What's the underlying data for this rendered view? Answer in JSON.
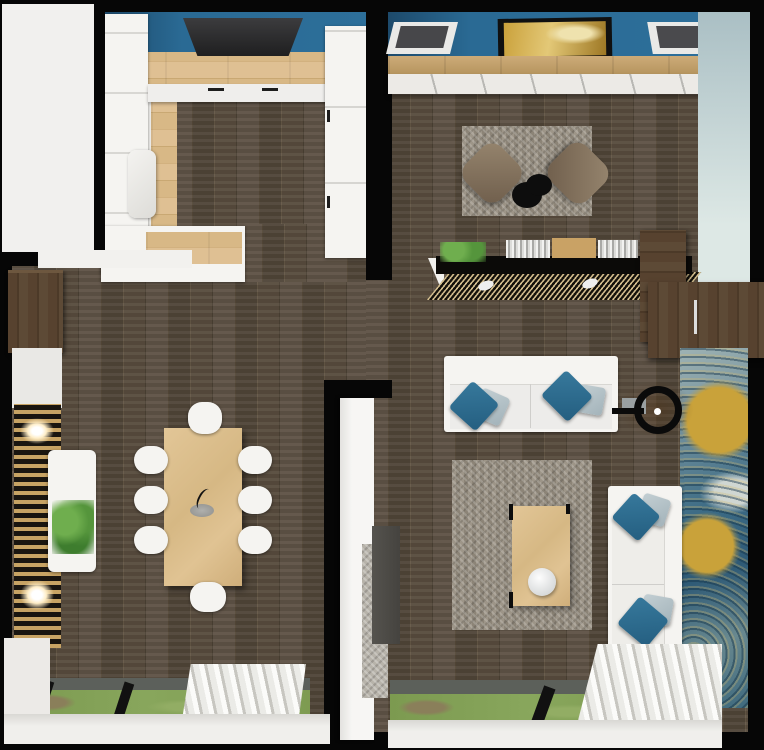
{
  "scene": {
    "title": "Apartment interior 3D floor plan, top-down render",
    "rooms": [
      {
        "id": "kitchen",
        "label": "Kitchen"
      },
      {
        "id": "dining-area",
        "label": "Dining area"
      },
      {
        "id": "living-room",
        "label": "Living room"
      },
      {
        "id": "hallway",
        "label": "Hallway"
      }
    ]
  },
  "labels": {
    "kitchen": "Kitchen",
    "dining_area": "Dining area",
    "living_room": "Living room",
    "hallway": "Hallway",
    "exterior": "Exterior",
    "kitchen_worktop": "Kitchen U-shaped worktop",
    "kitchen_blue_wall": "Blue kitchen wall",
    "range_hood": "Range hood",
    "sink": "Kitchen sink",
    "cabinets_left": "White cabinet run",
    "cabinets_tall": "Tall cabinet / fridge column",
    "counter_bottom": "Lower counter peninsula",
    "entry_wardrobe": "Entry wardrobe",
    "slat_wall": "Vertical wood slat accent wall",
    "wall_sconce": "Wall light",
    "floating_sideboard": "Floating sideboard",
    "plant": "Plant",
    "dining_table": "Dining table",
    "dining_chair": "Dining chair",
    "centerpiece": "Table centerpiece",
    "window": "Window with garden view",
    "window_mullion": "Window frame",
    "curtain": "Pleated curtain",
    "window_sill": "Window sill",
    "interior_door": "Open interior door",
    "partition_wall": "Partition wall",
    "tv_wall_blue": "Blue accent wall",
    "ceiling_light": "Recessed ceiling light panel",
    "painting": "Framed painting",
    "wall_shelf": "Wood wall shelf",
    "long_sideboard": "Long white sideboard",
    "teal_wall": "Pale teal side wall",
    "rug": "Gray shag area rug",
    "lounge_chair": "Lounge chair",
    "side_table": "Black side table",
    "media_console": "Slatted media console",
    "books": "Row of books",
    "open_door": "Open wood door",
    "mural": "Blue and gold wall mural",
    "sofa": "White sofa",
    "throw_pillow": "Throw pillow",
    "wall_clock": "Ring wall clock",
    "coffee_table": "Coffee table",
    "decor_bowl": "Decor bowl",
    "tv_unit": "TV unit",
    "floor_runner": "Gray floor runner"
  },
  "palette": {
    "wall_outline": "#060606",
    "blue_accent_wall": "#2a6a94",
    "teal_side_wall": "#c3d4d2",
    "dark_floor": "#574b3e",
    "light_wood": "#d9ba8b",
    "shag_rug_gray": "#968e81",
    "lounge_chair_brown": "#8a7966",
    "pillow_teal": "#2a6c90",
    "pillow_gray_blue": "#b3c2c8",
    "mural_blue": "#3c6b85",
    "mural_gold": "#c9a23a",
    "grass_green": "#7e9b51",
    "white_furniture": "#f5f4f1",
    "slat_wood": "#c7a364",
    "exterior_white": "#f1f0ee"
  }
}
